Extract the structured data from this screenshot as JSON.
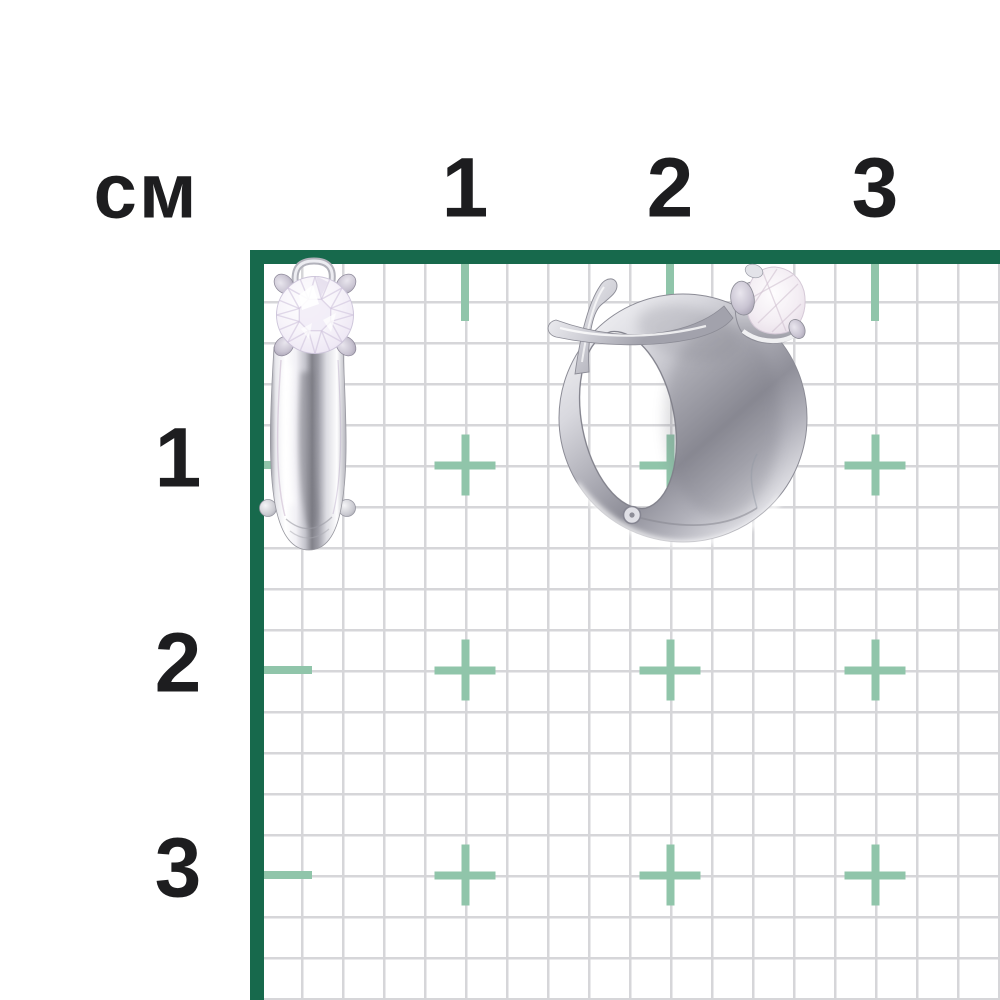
{
  "description": "Two silver earrings (a stud front view and a hoop side view, each with a round clear gemstone) photographed on a centimeter measurement grid",
  "ruler": {
    "unit_label": "см",
    "top_ticks": [
      "1",
      "2",
      "3"
    ],
    "left_ticks": [
      "1",
      "2",
      "3"
    ],
    "origin_px": 260,
    "cm_px": 205,
    "cell_px": 41,
    "cross_size_px": 61,
    "cross_thickness_px": 8,
    "colors": {
      "frame_green": "#17694c",
      "grid_line": "#d6d6d9",
      "cross_teal": "#90c5aa",
      "label_text": "#1d1d1f",
      "background": "#ffffff"
    }
  },
  "items": {
    "stud_earring": {
      "label": "stud-earring-front-view-with-round-stone"
    },
    "hoop_earring": {
      "label": "hoop-earring-side-view-with-round-stone"
    }
  }
}
